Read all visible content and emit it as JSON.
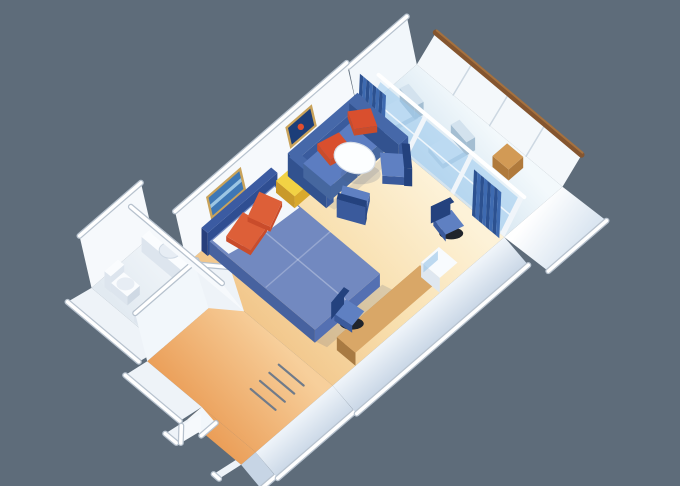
{
  "scene": {
    "name": "balcony-stateroom-3d-floor-plan",
    "background": "#5e6c7a",
    "rooms": [
      "balcony",
      "living-sleeping-area",
      "bathroom",
      "entry-corridor",
      "wardrobe-closet"
    ],
    "furniture": [
      "queen-bed",
      "bed-pillows",
      "headboard",
      "corner-sofa",
      "throw-pillows",
      "yellow-side-table",
      "round-cocktail-table",
      "tub-chairs",
      "vanity-desk",
      "minibar-cabinet",
      "desk-chairs",
      "wall-art-ocean",
      "wall-art-fish",
      "sliding-glass-doors",
      "curtains",
      "balcony-lounge-chairs",
      "balcony-side-table",
      "balcony-railing",
      "bathtub-vanity",
      "toilet",
      "pedestal-sink",
      "closet-rods",
      "entry-door"
    ]
  },
  "palette": {
    "background": "#5e6c7a",
    "wallFace": "#f6f9fc",
    "wallFace2": "#eef3f8",
    "wallFace3": "#f2f7fb",
    "cap": "#ffffff",
    "capEdge": "#b7c2ce",
    "roomFloorA": "#fdf2d8",
    "roomFloorB": "#f8dfae",
    "roomFloorC": "#f2c78c",
    "entryFloorA": "#f7cf9b",
    "entryFloorB": "#ea9c55",
    "bathFloorA": "#f2f6fa",
    "bathFloorB": "#e2eaf1",
    "balFloorA": "#f3f9fc",
    "balFloorB": "#d2e3ef",
    "rightWallA": "#f0f5fa",
    "rightWallB": "#c7d5e5",
    "tallWallA": "#ffffff",
    "tallWallB": "#dbe6f1",
    "glass": "rgba(156,202,238,0.55)",
    "glassDark": "rgba(120,170,215,0.45)",
    "mullion": "#f0f5fa",
    "curtainA": "#3e6ab0",
    "curtainB": "#2c5190",
    "woodCap": "#84552f",
    "woodCapHi": "#a5713f",
    "bedTop": "#7289c0",
    "bedSideS": "#5470b2",
    "bedSideW": "#47629f",
    "headboardS": "#2f4e92",
    "headboardW": "#273f7c",
    "headboardT": "#3b5ba2",
    "sheet": "#f3f7fb",
    "pillowA": "#dd5f38",
    "pillowB": "#c94c2b",
    "sofaBack": "#3a5b9d",
    "sofaBackT": "#4668a9",
    "sofaSide": "#32528f",
    "sofaSeat": "#5c7dc1",
    "sofaSeatSide": "#46679f",
    "redPillow": "#d94f2e",
    "yellowTop": "#f2d244",
    "yellowS": "#d9a92c",
    "yellowW": "#c9992a",
    "tableTop": "#fcfeff",
    "tableEdge": "#d9e0e9",
    "tableLeg": "#97a1ae",
    "chairSeat": "#5f80c2",
    "chairBack": "#24427e",
    "chairSide": "#3a5a9c",
    "deskTop": "#d9a767",
    "deskN": "#c08c4e",
    "deskW": "#a87a42",
    "cabinetN": "#eef3f8",
    "cabinetW": "#dfe7f0",
    "cabinetT": "#f8fbfe",
    "cabGlass": "rgba(150,195,230,0.6)",
    "chairBase": "#20242c",
    "white": "#fafcfe",
    "fixtureSide": "#dde5ee",
    "fixtureSide2": "#cfd9e4",
    "sinkIn": "#e7edf4",
    "reclTop": "#e2edf6",
    "reclSide": "#b9cfdf",
    "reclBackT": "#d3e2ee",
    "reclBackS": "#a4bed2",
    "balWood": "#d29a55",
    "balWoodS": "#b07a3c",
    "railWhite": "#f4f8fb",
    "railSeam": "#cdd8e2",
    "artFrame": "#c9a35b",
    "artOcean": "#3e77b5",
    "artOceanHi": "#9cc6e4",
    "artFish": "#1c3e79",
    "fishDot": "#e04f2e",
    "rodColor": "#707b8a",
    "shadow": "rgba(80,95,130,0.18)"
  }
}
